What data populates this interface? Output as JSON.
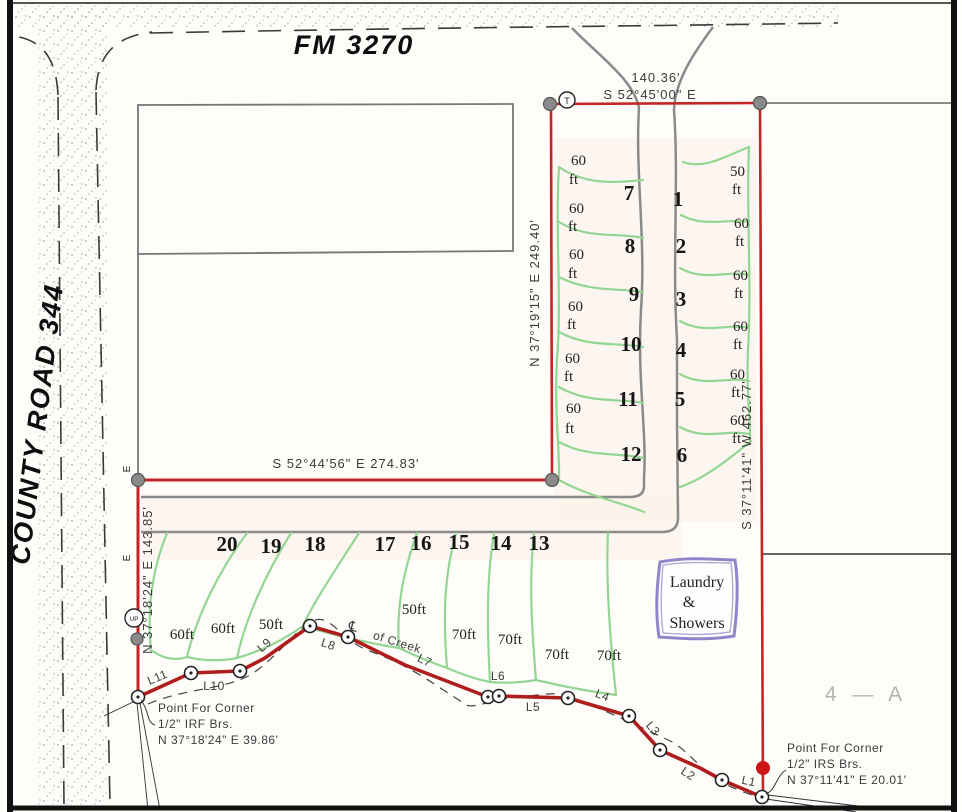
{
  "roads": {
    "top": "FM 3270",
    "left": "COUNTY ROAD 344"
  },
  "boundary": {
    "north_len": "140.36'",
    "north_bearing": "S 52°45'00\" E",
    "mid": "S 52°44'56\" E   274.83'",
    "west_upper": "N 37°19'15\" E   249.40'",
    "east": "S 37°11'41\" W   462.77'",
    "west_lower": "N 37°18'24\" E   143.85'"
  },
  "corner_sw": {
    "l1": "Point For Corner",
    "l2": "1/2\" IRF Brs.",
    "l3": "N 37°18'24\" E 39.86'"
  },
  "corner_se": {
    "l1": "Point For Corner",
    "l2": "1/2\" IRS Brs.",
    "l3": "N 37°11'41\" E 20.01'"
  },
  "markers": {
    "t": "T",
    "up": "UP",
    "e_upper": "E",
    "e_lower": "E"
  },
  "area_label": "4 — A",
  "creek": {
    "cl": "℄",
    "name": "of Creek",
    "segments": [
      "L1",
      "L2",
      "L3",
      "L4",
      "L5",
      "L6",
      "L7",
      "L8",
      "L9",
      "L10",
      "L11"
    ]
  },
  "laundry": {
    "l1": "Laundry",
    "l2": "&",
    "l3": "Showers"
  },
  "lots_left": [
    {
      "num": "7",
      "w": "60",
      "u": "ft"
    },
    {
      "num": "8",
      "w": "60",
      "u": "ft"
    },
    {
      "num": "9",
      "w": "60",
      "u": "ft"
    },
    {
      "num": "10",
      "w": "60",
      "u": "ft"
    },
    {
      "num": "11",
      "w": "60",
      "u": "ft"
    },
    {
      "num": "12",
      "w": "60",
      "u": "ft"
    }
  ],
  "lots_right": [
    {
      "num": "1",
      "w": "50",
      "u": "ft"
    },
    {
      "num": "2",
      "w": "60",
      "u": "ft"
    },
    {
      "num": "3",
      "w": "60",
      "u": "ft"
    },
    {
      "num": "4",
      "w": "60",
      "u": "ft"
    },
    {
      "num": "5",
      "w": "60",
      "u": "ft"
    },
    {
      "num": "6",
      "w": "60",
      "u": "ft"
    }
  ],
  "lots_bottom": [
    {
      "num": "20",
      "w": "60ft"
    },
    {
      "num": "19",
      "w": "60ft"
    },
    {
      "num": "18",
      "w": "50ft"
    },
    {
      "num": "17",
      "w": "50ft"
    },
    {
      "num": "16",
      "w": "70ft"
    },
    {
      "num": "15",
      "w": "70ft"
    },
    {
      "num": "14",
      "w": "70ft"
    },
    {
      "num": "13",
      "w": "70ft"
    }
  ],
  "colors": {
    "boundary_red": "#c32424",
    "creek_red": "#b01d1d",
    "lot_green": "#93d693",
    "road_gray": "#8a8a8a",
    "laundry_purple": "#9184c9"
  }
}
